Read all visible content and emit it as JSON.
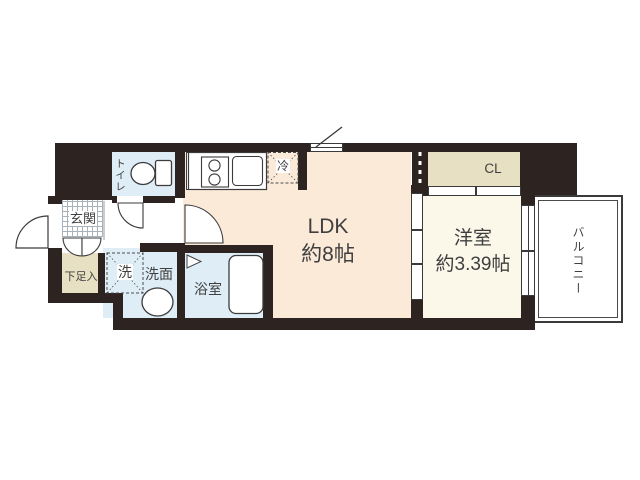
{
  "rooms": {
    "ldk": {
      "name": "LDK",
      "area": "約8帖"
    },
    "western": {
      "name": "洋室",
      "area": "約3.39帖"
    },
    "balcony": {
      "name": "バルコニー"
    },
    "toilet": {
      "name": "トイレ"
    },
    "entrance": {
      "name": "玄関"
    },
    "shoe_cabinet": {
      "name": "下足入"
    },
    "washing_machine": {
      "name": "洗"
    },
    "washroom": {
      "name": "洗面"
    },
    "bathroom": {
      "name": "浴室"
    },
    "closet": {
      "name": "CL"
    },
    "refrigerator": {
      "name": "冷"
    }
  },
  "colors": {
    "wall": "#2d2320",
    "ldk_floor": "#fcead9",
    "western_floor": "#fbf8e9",
    "wet_area_floor": "#dfeef6",
    "storage_floor": "#e8e0c2",
    "outline": "#3a3a3a"
  }
}
